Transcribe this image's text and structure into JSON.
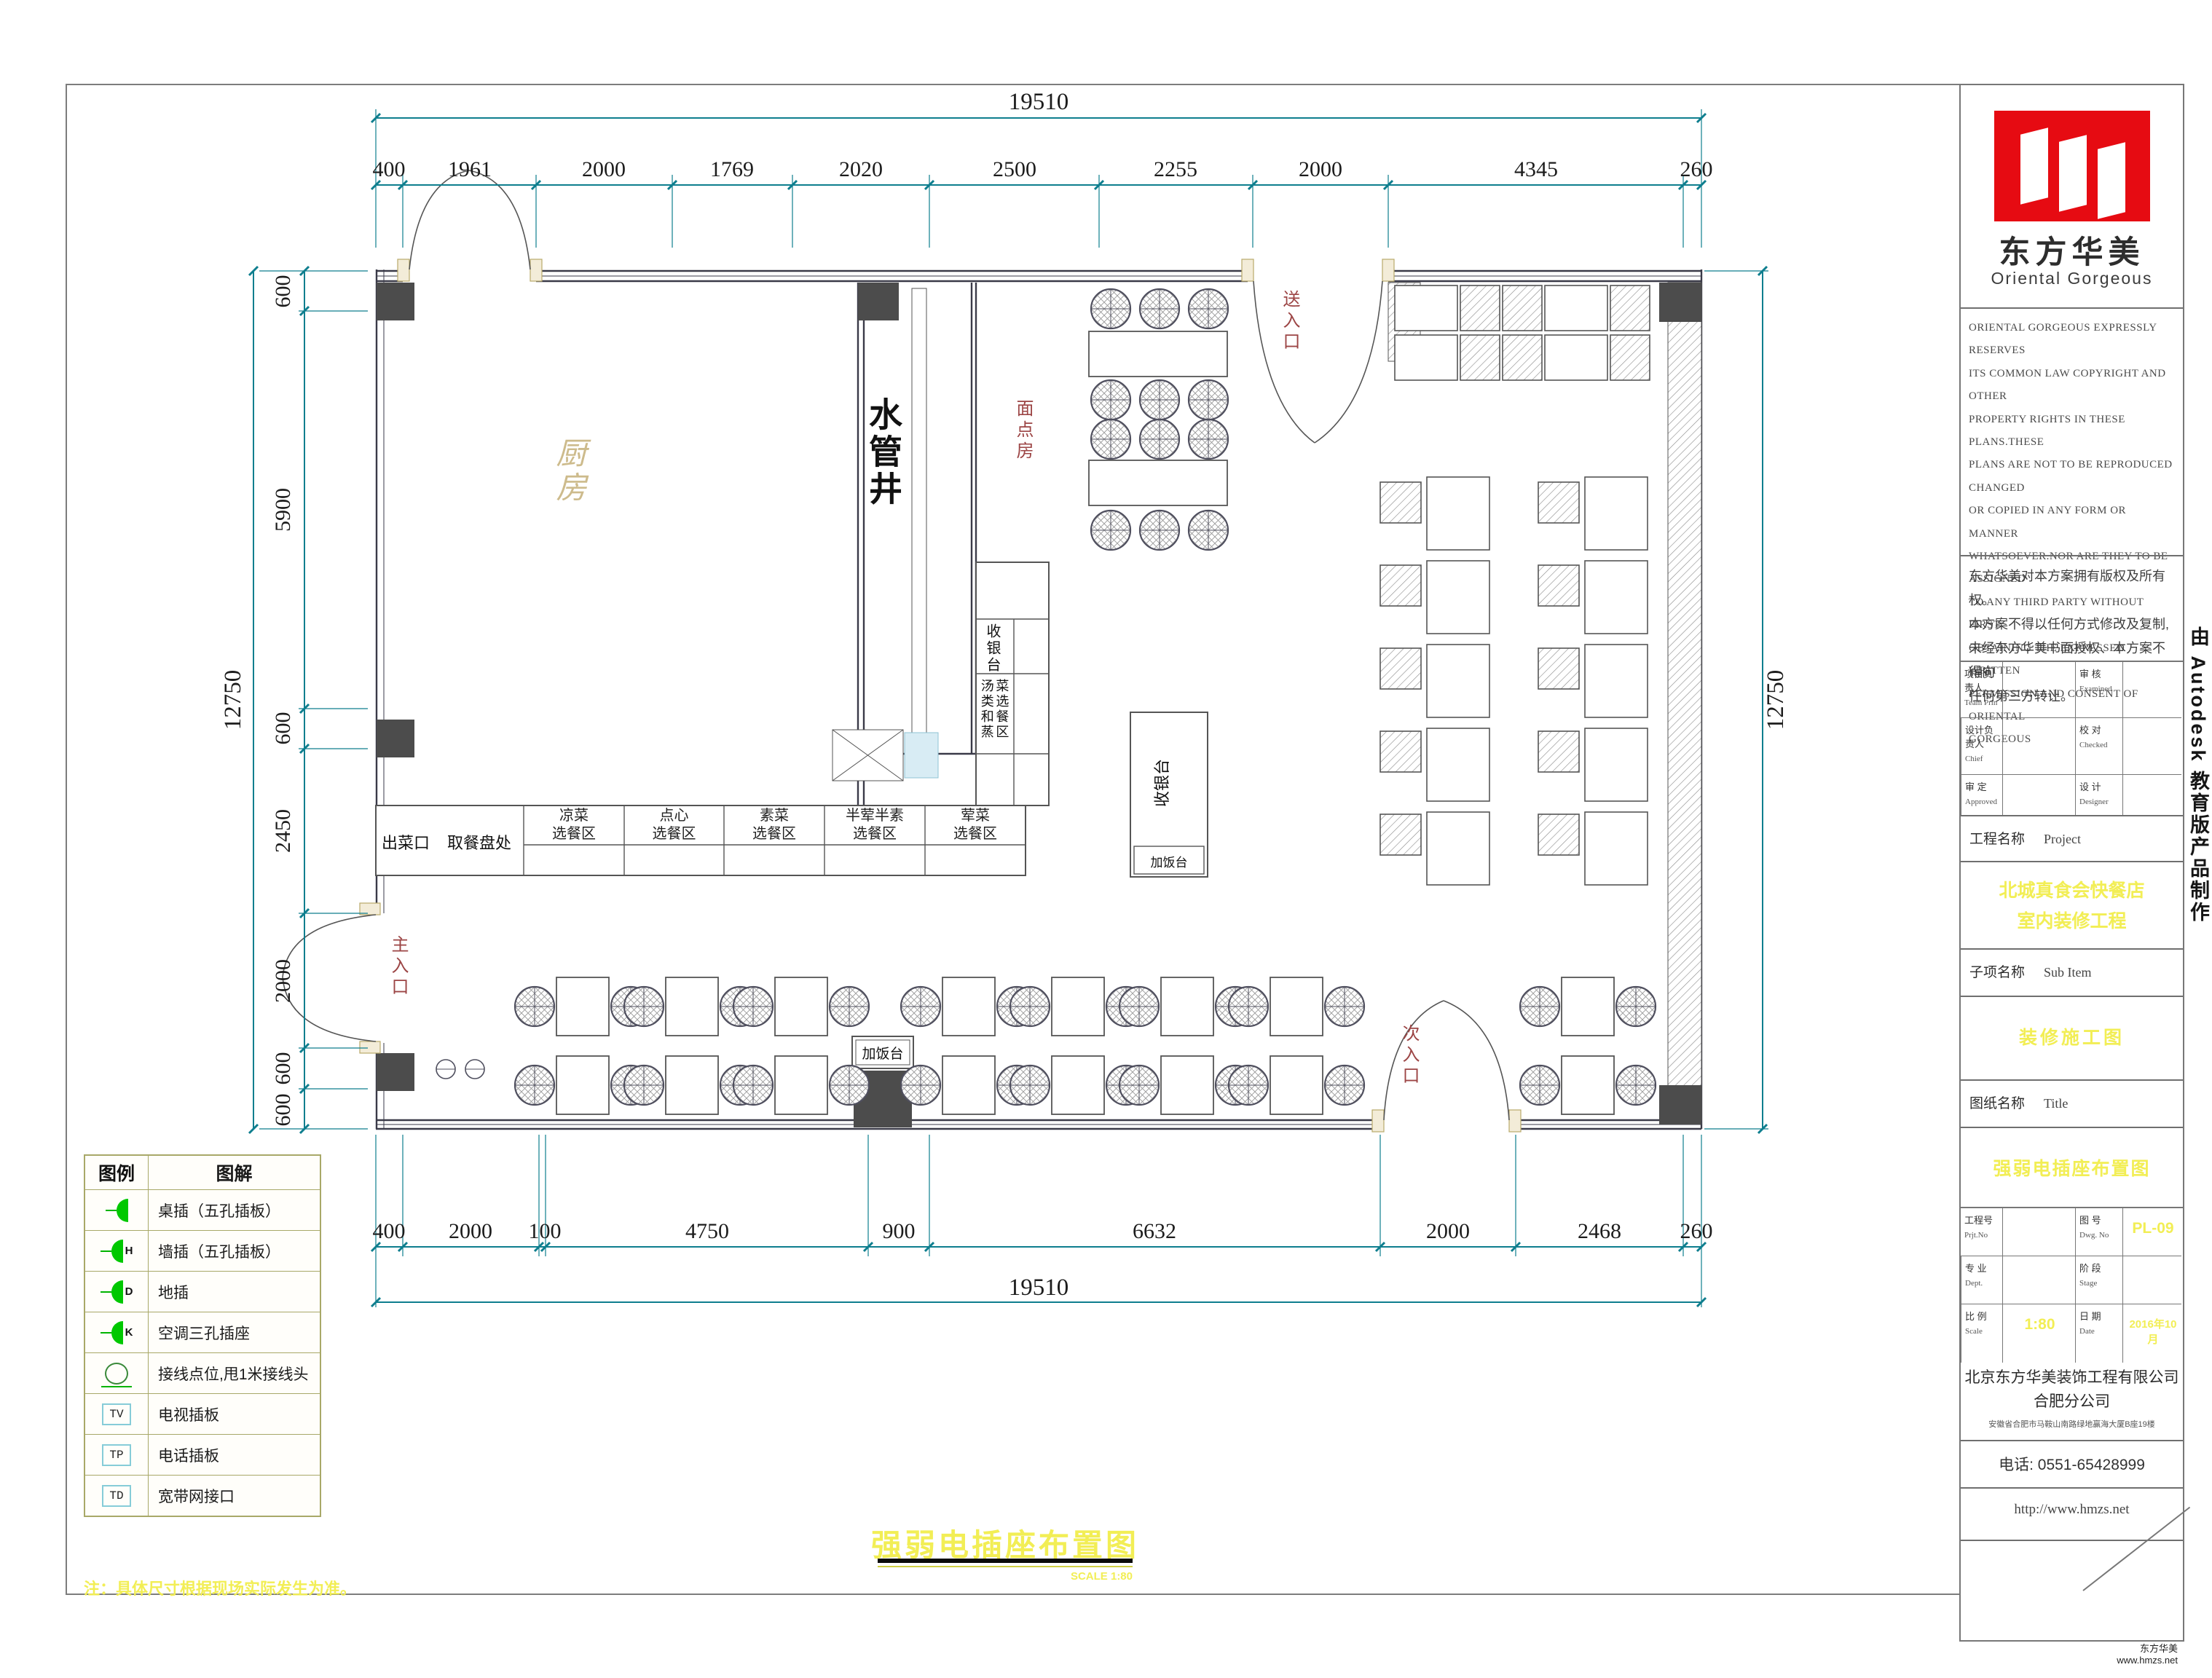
{
  "dims": {
    "top_total": "19510",
    "top_segments": [
      "400",
      "1961",
      "2000",
      "1769",
      "2020",
      "2500",
      "2255",
      "2000",
      "4345",
      "260"
    ],
    "left_segments": [
      "600",
      "5900",
      "600",
      "2450",
      "2000",
      "600",
      "600"
    ],
    "left_total": "12750",
    "right_total": "12750",
    "bottom_segments": [
      "400",
      "2000",
      "100",
      "4750",
      "900",
      "6632",
      "2000",
      "2468",
      "260"
    ],
    "bottom_total": "19510"
  },
  "plan": {
    "kitchen": "厨房",
    "water_shaft": "水管井",
    "pastry_room": "面点房",
    "delivery_entrance": "送入口",
    "main_entrance": "主入口",
    "secondary_entrance": "次入口",
    "serving_exit": "出菜口",
    "tray_pickup": "取餐盘处",
    "cold_area": "凉菜\n选餐区",
    "dimsum_area": "点心\n选餐区",
    "veg_area": "素菜\n选餐区",
    "half_area": "半荤半素\n选餐区",
    "meat_area": "荤菜\n选餐区",
    "cashier_counter": "收银台",
    "soup_steam_area": "汤类和蒸菜选餐区",
    "cashier_desk": "收银台",
    "rice_station_desk": "加饭台",
    "rice_station": "加饭台"
  },
  "legend": {
    "header_symbol": "图例",
    "header_desc": "图解",
    "rows": [
      {
        "type": "socket",
        "tag": "",
        "label": "桌插（五孔插板）"
      },
      {
        "type": "socket",
        "tag": "H",
        "label": "墙插（五孔插板）"
      },
      {
        "type": "socket",
        "tag": "D",
        "label": "地插"
      },
      {
        "type": "socket",
        "tag": "K",
        "label": "空调三孔插座"
      },
      {
        "type": "junction",
        "tag": "",
        "label": "接线点位,甩1米接线头"
      },
      {
        "type": "box",
        "tag": "TV",
        "label": "电视插板"
      },
      {
        "type": "box",
        "tag": "TP",
        "label": "电话插板"
      },
      {
        "type": "box",
        "tag": "TD",
        "label": "宽带网接口"
      }
    ]
  },
  "footer": {
    "drawing_title": "强弱电插座布置图",
    "scale_note": "SCALE 1:80",
    "site_note": "注：具体尺寸根据现场实际发生为准。",
    "brand": "东方华美",
    "brand_url": "www.hmzs.net"
  },
  "side_strip": {
    "text": "由 Autodesk 教育版产品制作"
  },
  "titleblock": {
    "logo_cn": "东方华美",
    "logo_en": "Oriental Gorgeous",
    "copyright_en": "ORIENTAL GORGEOUS EXPRESSLY RESERVES\nITS COMMON LAW COPYRIGHT AND OTHER\nPROPERTY RIGHTS IN THESE PLANS.THESE\nPLANS ARE NOT TO BE REPRODUCED CHANGED\nOR COPIED IN ANY FORM OR MANNER\nWHATSOEVER.NOR ARE THEY TO BE ASSIGNED\nTO ANY THIRD PARTY WITHOUT FIRST\nOBTAINING THE EXPRESSED WRITTEN\nPERMISSION AND CONSENT OF ORIENTAL\nGORGEOUS",
    "copyright_cn": "东方华美对本方案拥有版权及所有权。\n本方案不得以任何方式修改及复制,\n未经东方华美书面授权、本方案不得向\n任何第三方转让。",
    "roles": [
      {
        "cn": "项目负责人",
        "en": "Team Prin"
      },
      {
        "cn": "审 核",
        "en": "Examined"
      },
      {
        "cn": "设计负责人",
        "en": "Chief"
      },
      {
        "cn": "校 对",
        "en": "Checked"
      },
      {
        "cn": "审 定",
        "en": "Approved"
      },
      {
        "cn": "设 计",
        "en": "Designer"
      }
    ],
    "project_label": "工程名称",
    "project_label_en": "Project",
    "project_name": "北城真食会快餐店\n室内装修工程",
    "subitem_label": "子项名称",
    "subitem_label_en": "Sub Item",
    "subitem_value": "装修施工图",
    "sheet_label": "图纸名称",
    "sheet_label_en": "Title",
    "sheet_value": "强弱电插座布置图",
    "prj_no_cn": "工程号",
    "prj_no_en": "Prjt.No",
    "dwg_no_cn": "图 号",
    "dwg_no_en": "Dwg. No",
    "dwg_no_value": "PL-09",
    "dept_cn": "专 业",
    "dept_en": "Dept.",
    "stage_cn": "阶 段",
    "stage_en": "Stage",
    "scale_cn": "比 例",
    "scale_en": "Scale",
    "scale_value": "1:80",
    "date_cn": "日 期",
    "date_en": "Date",
    "date_value": "2016年10月",
    "company": "北京东方华美装饰工程有限公司\n合肥分公司",
    "address": "安徽省合肥市马鞍山南路绿地赢海大厦B座19楼",
    "phone": "电话: 0551-65428999",
    "website": "http://www.hmzs.net"
  }
}
